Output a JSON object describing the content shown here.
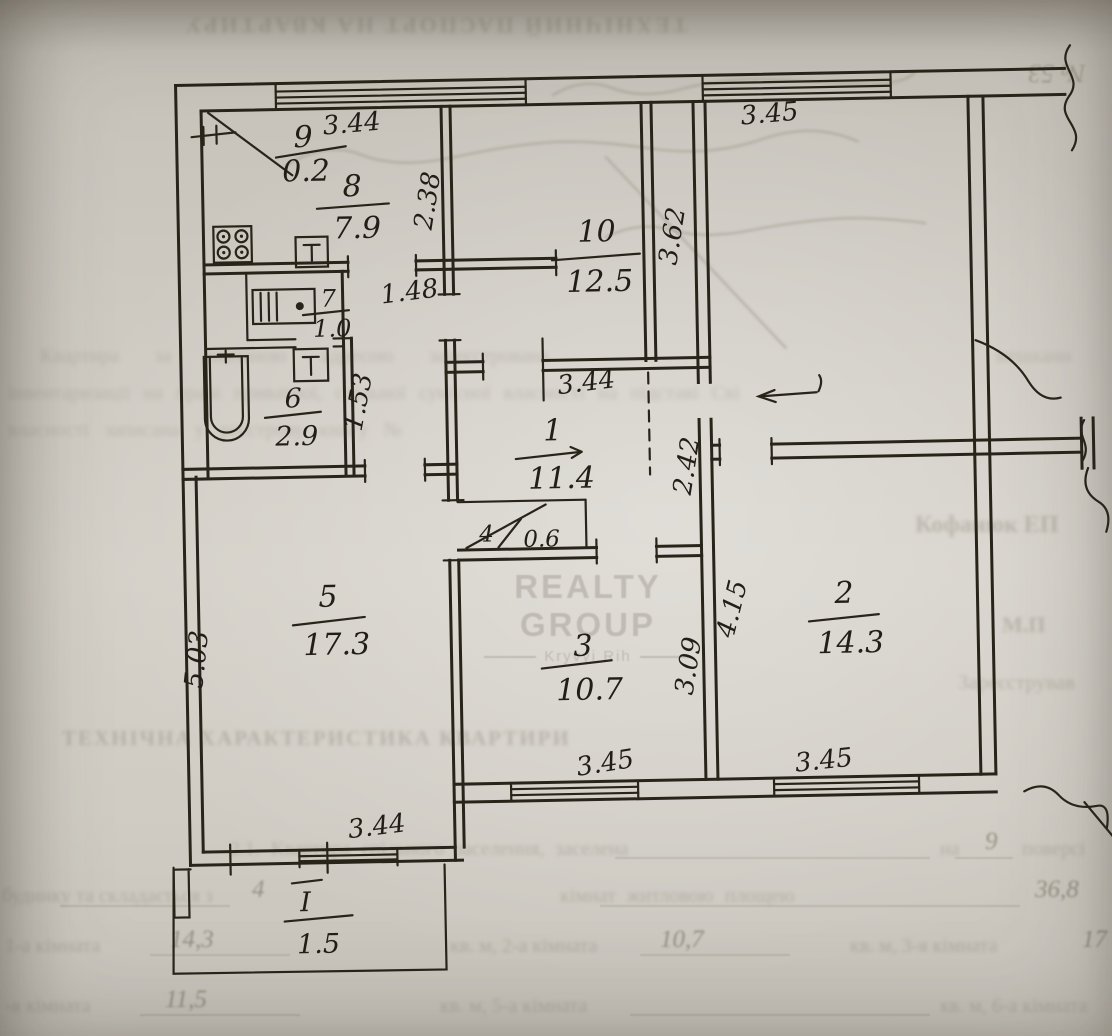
{
  "document": {
    "bleed_title": "ТЕХНІЧНИЙ ПАСПОРТ НА КВАРТИРУ",
    "case_number": "№ 53",
    "registration_note": {
      "line1": "Квартира  за  вказаною  адресою  зареєстрована",
      "line1_end": "мешканн",
      "line2": "інвентаризації  на  праві  приватної,  спільної  сумісної  власності  на  підставі  Сві",
      "line3": "власності  записана  у  реєстрову  книгу  №"
    },
    "officials": {
      "name": "Кофанюк ЕП",
      "seal": "М.П",
      "registered_by": "Зареєстрував"
    },
    "section_heading": "ТЕХНІЧНА ХАРАКТЕРИСТИКА КВАРТИРИ",
    "section_2_1": {
      "line1_text": "2.1.  Квартира  спільного  заселення,  заселена",
      "line1_mid": "на",
      "line1_value": "9",
      "line1_end": "поверсі",
      "line2_text": "будинку та складається з",
      "line2_value": "4",
      "line2_text2": "кімнат житловою площею",
      "line2_value2": "36,8",
      "line3_text1": "1-а кімната",
      "line3_value1": "14,3",
      "line3_text2": "кв. м,  2-а кімната",
      "line3_value2": "10,7",
      "line3_text3": "кв. м,  3-я кімната",
      "line3_value3": "17",
      "line4_text1": "-я кімната",
      "line4_value1": "11,5",
      "line4_text2": "кв. м,  5-а кімната",
      "line4_text3": "кв. м,  6-а кімната"
    },
    "watermark": {
      "line1": "REALTY GROUP",
      "line2": "Kryvyi Rih"
    }
  },
  "floor_plan": {
    "rooms": {
      "r1": {
        "num": "1",
        "area": "11.4"
      },
      "r2": {
        "num": "2",
        "area": "14.3"
      },
      "r3": {
        "num": "3",
        "area": "10.7"
      },
      "r4": {
        "num": "4",
        "area": "0.6"
      },
      "r5": {
        "num": "5",
        "area": "17.3"
      },
      "r6": {
        "num": "6",
        "area": "2.9"
      },
      "r7": {
        "num": "7",
        "area": "1.0"
      },
      "r8": {
        "num": "8",
        "area": "7.9"
      },
      "r9": {
        "num": "9",
        "area": "0.2"
      },
      "r10": {
        "num": "10",
        "area": "12.5"
      },
      "balcony": {
        "num": "I",
        "area": "1.5"
      }
    },
    "dims": {
      "top_window_left": "3.44",
      "top_window_right": "3.45",
      "kitchen_depth": "2.38",
      "room10_depth": "3.62",
      "kitchen_passage": "1.48",
      "bath_wall": "1.53",
      "hall_length": "3.44",
      "entry_wall": "2.42",
      "room2_depth": "4.15",
      "room3_depth": "3.09",
      "room5_depth": "5.03",
      "room5_window": "3.44",
      "room3_window": "3.45",
      "room2_window": "3.45"
    }
  }
}
